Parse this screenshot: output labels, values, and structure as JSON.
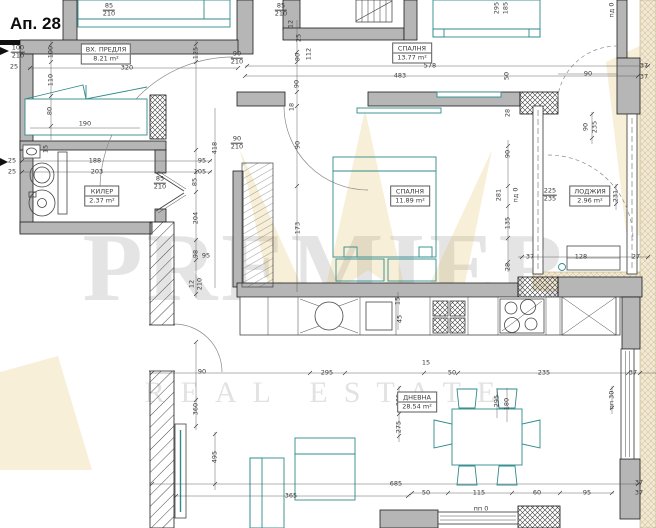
{
  "title": "Ап. 28",
  "watermark": {
    "line1": "PREMIER",
    "line2": "REAL ESTATE"
  },
  "colors": {
    "furniture": "#2F8B8C",
    "wall_fill": "#b6b6b6",
    "watermark_gold": "#dfb64e",
    "dim_text": "#3a3a3a"
  },
  "rooms": [
    {
      "name": "ВХ. ПРЕДЛЯ",
      "area": "8.21 m²",
      "x": 106,
      "y": 54
    },
    {
      "name": "СПАЛНЯ",
      "area": "13.77 m²",
      "x": 412,
      "y": 53
    },
    {
      "name": "СПАЛНЯ",
      "area": "11.89 m²",
      "x": 410,
      "y": 196
    },
    {
      "name": "КИЛЕР",
      "area": "2.37 m²",
      "x": 102,
      "y": 196
    },
    {
      "name": "ЛОДЖИЯ",
      "area": "2.96 m²",
      "x": 590,
      "y": 196
    },
    {
      "name": "ДНЕВНА",
      "area": "28.54 m²",
      "x": 417,
      "y": 402
    }
  ],
  "dim_labels": [
    {
      "t": "85",
      "f": "210",
      "x": 109,
      "y": 10
    },
    {
      "t": "85",
      "f": "210",
      "x": 281,
      "y": 10
    },
    {
      "t": "12",
      "x": 291,
      "y": 24,
      "r": 1
    },
    {
      "t": "25",
      "x": 299,
      "y": 38,
      "r": 1
    },
    {
      "t": "100",
      "f": "210",
      "x": 18,
      "y": 52
    },
    {
      "t": "25",
      "x": 14,
      "y": 67
    },
    {
      "t": "100",
      "x": 51,
      "y": 52,
      "r": 1
    },
    {
      "t": "110",
      "x": 51,
      "y": 80,
      "r": 1
    },
    {
      "t": "80",
      "x": 50,
      "y": 111,
      "r": 1
    },
    {
      "t": "15",
      "x": 46,
      "y": 149,
      "r": 1
    },
    {
      "t": "320",
      "x": 127,
      "y": 68
    },
    {
      "t": "125",
      "x": 196,
      "y": 53,
      "r": 1
    },
    {
      "t": "90",
      "f": "210",
      "x": 237,
      "y": 58
    },
    {
      "t": "112",
      "x": 309,
      "y": 54,
      "r": 1
    },
    {
      "t": "578",
      "x": 430,
      "y": 66
    },
    {
      "t": "483",
      "x": 400,
      "y": 76
    },
    {
      "t": "295",
      "x": 497,
      "y": 8,
      "r": 1
    },
    {
      "t": "185",
      "x": 506,
      "y": 8,
      "r": 1
    },
    {
      "t": "пд 0",
      "x": 612,
      "y": 10,
      "r": 1
    },
    {
      "t": "37",
      "x": 644,
      "y": 66
    },
    {
      "t": "37",
      "x": 644,
      "y": 77
    },
    {
      "t": "90",
      "x": 588,
      "y": 74
    },
    {
      "t": "50",
      "x": 507,
      "y": 76,
      "r": 1
    },
    {
      "t": "28",
      "x": 508,
      "y": 113,
      "r": 1
    },
    {
      "t": "90",
      "x": 586,
      "y": 127,
      "r": 1
    },
    {
      "t": "235",
      "x": 595,
      "y": 127,
      "r": 1
    },
    {
      "t": "90",
      "x": 298,
      "y": 57,
      "r": 1
    },
    {
      "t": "90",
      "x": 297,
      "y": 84,
      "r": 1
    },
    {
      "t": "18",
      "x": 292,
      "y": 107,
      "r": 1
    },
    {
      "t": "90",
      "x": 298,
      "y": 145,
      "r": 1
    },
    {
      "t": "173",
      "x": 298,
      "y": 228,
      "r": 1
    },
    {
      "t": "90",
      "f": "210",
      "x": 237,
      "y": 143
    },
    {
      "t": "190",
      "x": 85,
      "y": 124
    },
    {
      "t": "188",
      "x": 95,
      "y": 161
    },
    {
      "t": "203",
      "x": 97,
      "y": 172
    },
    {
      "t": "95",
      "x": 202,
      "y": 161
    },
    {
      "t": "105",
      "x": 200,
      "y": 172
    },
    {
      "t": "85",
      "x": 195,
      "y": 182,
      "r": 1
    },
    {
      "t": "85",
      "f": "210",
      "x": 160,
      "y": 183
    },
    {
      "t": "204",
      "x": 196,
      "y": 218,
      "r": 1
    },
    {
      "t": "98",
      "x": 196,
      "y": 254,
      "r": 1
    },
    {
      "t": "95",
      "x": 206,
      "y": 256
    },
    {
      "t": "12",
      "x": 192,
      "y": 284,
      "r": 1
    },
    {
      "t": "210",
      "x": 200,
      "y": 284,
      "r": 1
    },
    {
      "t": "418",
      "x": 215,
      "y": 148,
      "r": 1
    },
    {
      "t": "25",
      "x": 12,
      "y": 161
    },
    {
      "t": "25",
      "x": 12,
      "y": 172
    },
    {
      "t": "225",
      "f": "235",
      "x": 550,
      "y": 195
    },
    {
      "t": "281",
      "x": 499,
      "y": 195,
      "r": 1
    },
    {
      "t": "пд 0",
      "x": 516,
      "y": 195,
      "r": 1
    },
    {
      "t": "90",
      "x": 508,
      "y": 154,
      "r": 1
    },
    {
      "t": "135",
      "x": 508,
      "y": 223,
      "r": 1
    },
    {
      "t": "231",
      "x": 616,
      "y": 196,
      "r": 1
    },
    {
      "t": "128",
      "x": 581,
      "y": 257
    },
    {
      "t": "27",
      "x": 636,
      "y": 257
    },
    {
      "t": "37",
      "x": 530,
      "y": 257
    },
    {
      "t": "28",
      "x": 508,
      "y": 267,
      "r": 1
    },
    {
      "t": "295",
      "x": 327,
      "y": 373
    },
    {
      "t": "15",
      "x": 426,
      "y": 363
    },
    {
      "t": "50",
      "x": 452,
      "y": 373
    },
    {
      "t": "235",
      "x": 544,
      "y": 373
    },
    {
      "t": "37",
      "x": 633,
      "y": 373
    },
    {
      "t": "15",
      "x": 398,
      "y": 301,
      "r": 1
    },
    {
      "t": "45",
      "x": 400,
      "y": 319,
      "r": 1
    },
    {
      "t": "295",
      "x": 497,
      "y": 401,
      "r": 1
    },
    {
      "t": "180",
      "x": 507,
      "y": 404,
      "r": 1
    },
    {
      "t": "пп 30",
      "x": 612,
      "y": 400,
      "r": 1
    },
    {
      "t": "90",
      "x": 202,
      "y": 372
    },
    {
      "t": "360",
      "x": 196,
      "y": 409,
      "r": 1
    },
    {
      "t": "495",
      "x": 215,
      "y": 457,
      "r": 1
    },
    {
      "t": "305",
      "x": 399,
      "y": 400,
      "r": 1
    },
    {
      "t": "275",
      "x": 399,
      "y": 427,
      "r": 1
    },
    {
      "t": "365",
      "x": 291,
      "y": 496
    },
    {
      "t": "685",
      "x": 396,
      "y": 484
    },
    {
      "t": "50",
      "x": 426,
      "y": 493
    },
    {
      "t": "115",
      "x": 479,
      "y": 493
    },
    {
      "t": "60",
      "x": 537,
      "y": 493
    },
    {
      "t": "95",
      "x": 587,
      "y": 493
    },
    {
      "t": "37",
      "x": 639,
      "y": 483
    },
    {
      "t": "37",
      "x": 639,
      "y": 493
    },
    {
      "t": "пп 0",
      "x": 481,
      "y": 509
    }
  ]
}
